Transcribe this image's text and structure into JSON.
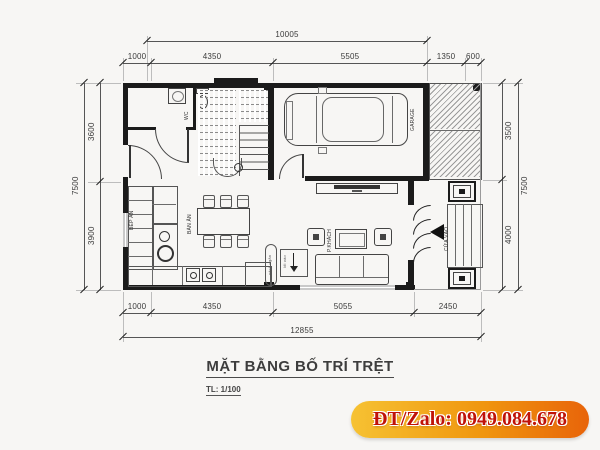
{
  "title": {
    "text": "MẶT BẰNG BỐ TRÍ TRỆT",
    "scale": "TL: 1/100"
  },
  "contact": {
    "phone_label": "ĐT/Zalo: 0949.084.678"
  },
  "dims": {
    "top_total": "10005",
    "top": [
      "1000",
      "4350",
      "5505",
      "1350",
      "600"
    ],
    "left": [
      "3600",
      "3900"
    ],
    "left_total": "7500",
    "right": [
      "3500",
      "4000"
    ],
    "right_total": "7500",
    "bottom": [
      "1000",
      "4350",
      "5055",
      "2450"
    ],
    "bottom_total": "12855"
  },
  "labels": {
    "wc": "WC",
    "garage": "GARAGE",
    "entry": "CỬA VÀO",
    "kitchen": "BẾP ĂN",
    "dining": "BÀN ĂN",
    "living": "P.KHÁCH",
    "partition": "vách ngăn",
    "entry_note": "lối vào"
  },
  "colors": {
    "banner_gradient_start": "#f6c233",
    "banner_gradient_end": "#e8640a",
    "banner_text": "#c01208",
    "line": "#2b2b2b",
    "hatch": "#9a9a9a"
  }
}
